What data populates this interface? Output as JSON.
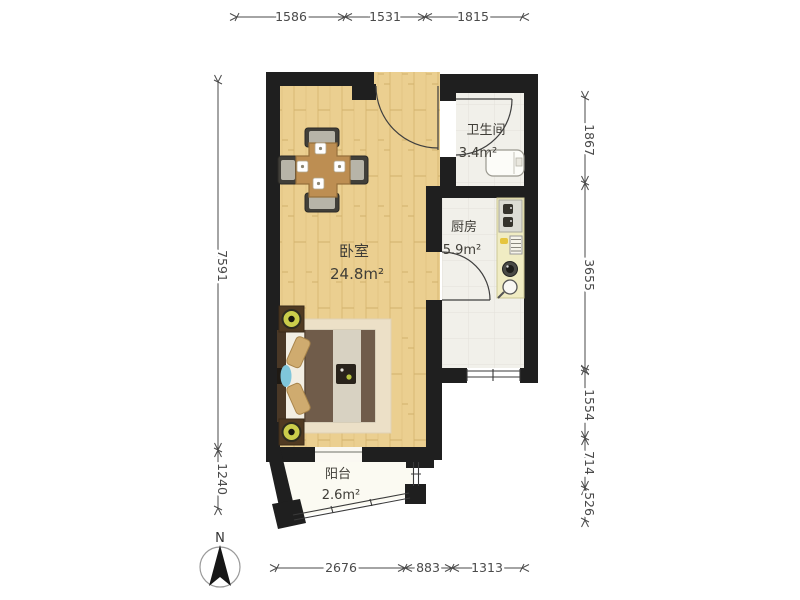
{
  "plan": {
    "title": "one-bedroom-apartment-floor-plan",
    "rooms": [
      {
        "id": "bedroom",
        "name": "卧室",
        "area": "24.8m²"
      },
      {
        "id": "bathroom",
        "name": "卫生间",
        "area": "3.4m²"
      },
      {
        "id": "kitchen",
        "name": "厨房",
        "area": "5.9m²"
      },
      {
        "id": "balcony",
        "name": "阳台",
        "area": "2.6m²"
      }
    ],
    "compass_label": "N"
  },
  "dimensions": {
    "top": [
      "1586",
      "1531",
      "1815"
    ],
    "left": [
      "7591",
      "1240"
    ],
    "right": [
      "1867",
      "3655",
      "1554",
      "714",
      "526"
    ],
    "bottom": [
      "2676",
      "883",
      "1313"
    ]
  },
  "colors": {
    "wall": "#1f1f1f",
    "wood_floor": "#ebcf90",
    "wood_line": "#dcbd79",
    "tile_floor": "#f1f0ea",
    "balcony_floor": "#fbfaf2",
    "counter": "#f0ecc3",
    "table": "#bd8e52",
    "bed_blanket": "#705c4a",
    "rug": "#ece0c7",
    "lamp": "#cacd4b",
    "towel_blue": "#7fc6db",
    "dim_line": "#4a4a4a",
    "label_text": "#3f3d37"
  }
}
